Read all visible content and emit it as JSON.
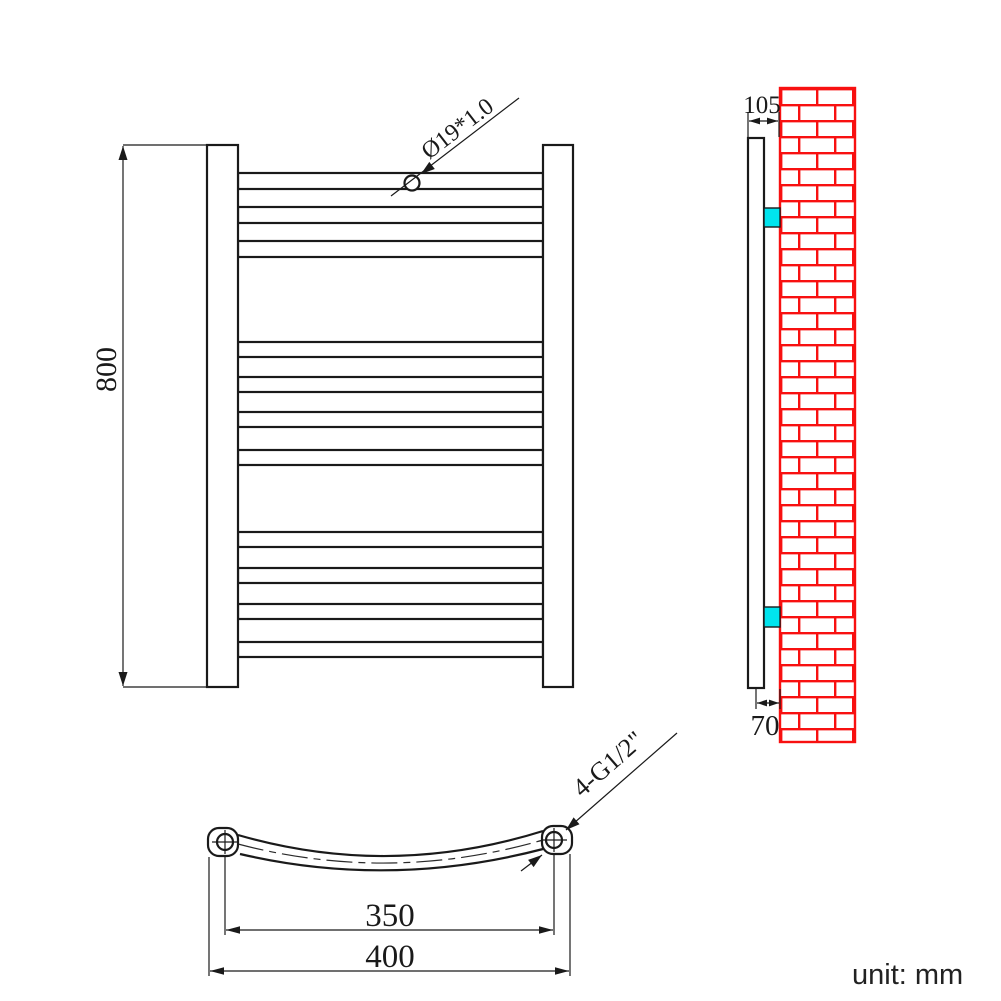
{
  "drawing": {
    "type": "technical-drawing",
    "subject": "ladder towel radiator, three orthographic views with brick wall mounting detail",
    "unit_note": "unit: mm",
    "front_view": {
      "height_dim": "800",
      "bar_spec": "Ø19*1.0",
      "bar_count": 11,
      "bar_groups": [
        3,
        4,
        4
      ]
    },
    "side_view": {
      "depth_dim": "105",
      "wall_offset_dim": "70",
      "bracket_count": 2
    },
    "bottom_view": {
      "bracket_centers_dim": "350",
      "overall_width_dim": "400",
      "connection_spec": "4-G1/2\""
    },
    "colors": {
      "line": "#1a1a1a",
      "brick_red": "#f81010",
      "bracket_cyan": "#00e4ee"
    }
  }
}
